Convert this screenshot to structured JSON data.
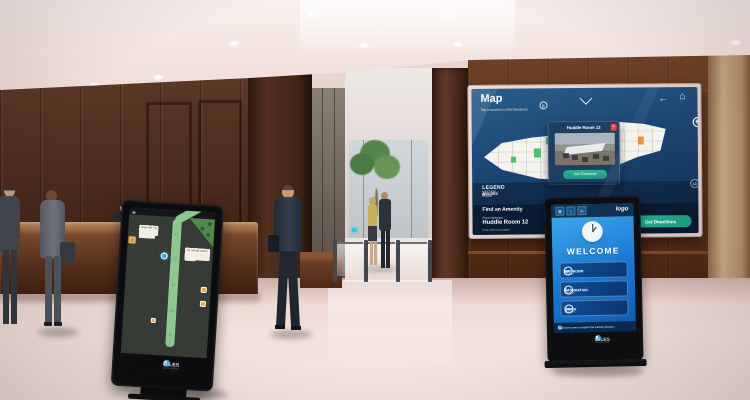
{
  "scene": {
    "description": "Corporate lobby with wall-mounted wayfinding display and two digital signage kiosks",
    "colors": {
      "wood": "#5a3a28",
      "floor": "#f2e0da",
      "screen_navy": "#1b4571",
      "kiosk_blue": "#1976d2",
      "accent_green": "#27b191",
      "brand_blue": "#35b1e8"
    }
  },
  "wall_display": {
    "title": "Map",
    "subtitle": "Tap a location to Get Directions",
    "nav": {
      "back_glyph": "←",
      "home_glyph": "⌂",
      "accessibility_glyph": "♿"
    },
    "side_controls": [
      {
        "name": "zoom-in",
        "glyph": "+"
      },
      {
        "name": "zoom-out",
        "glyph": "−"
      },
      {
        "name": "reset",
        "glyph": "↺"
      },
      {
        "name": "locate",
        "glyph": "◉"
      }
    ],
    "popup": {
      "title": "Huddle Room 12",
      "close_glyph": "×",
      "cta": "Get Directions"
    },
    "legend": {
      "label": "LEGEND",
      "items": [
        {
          "label": "AVAILABLE",
          "color": "#4cc06a"
        },
        {
          "label": "MEETING ROOM",
          "color": "#c05ce0"
        },
        {
          "label": "OCCUPIED",
          "color": "#e8c93c"
        }
      ]
    },
    "floors": {
      "campus": "CAMPUS",
      "levels": [
        "L1",
        "L2",
        "L3"
      ]
    },
    "amenity": {
      "header": "Find an Amenity",
      "selected_label": "Room Selected",
      "selected_room": "Huddle Room 12",
      "selected_sub": "from Current Location",
      "shortcuts": [
        {
          "glyph": "⇅",
          "label": "Elevator"
        },
        {
          "glyph": "↗",
          "label": "Exit"
        }
      ],
      "cta": "Get Directions",
      "cta_arrow": "→"
    }
  },
  "welcome_kiosk": {
    "logo": "logo",
    "topbar_tiles": [
      {
        "name": "directory-icon",
        "glyph": "▦"
      },
      {
        "name": "building-icon",
        "glyph": "⌂"
      },
      {
        "name": "map-icon",
        "glyph": "◎"
      }
    ],
    "welcome": "WELCOME",
    "rows": [
      {
        "icon_glyph": "WC",
        "label": "RESTROOM",
        "sub": "Tap for directions",
        "arrow": "→"
      },
      {
        "icon_glyph": "i",
        "label": "INFORMATION",
        "sub": "Tap for directions",
        "arrow": "↑"
      },
      {
        "icon_glyph": "Ψ",
        "label": "DINING",
        "sub": "Tap for directions",
        "arrow": "↓"
      }
    ],
    "ticker_info_glyph": "i",
    "ticker": "Touch the screen to explore the building directory",
    "brand": {
      "num": "22",
      "name": "MILES",
      "tagline": "DIGITAL SIGNAGE · WAYFINDING"
    }
  },
  "directory_kiosk": {
    "stores_left": [
      "Sole",
      "AT&T",
      "Sprint",
      "GameStop",
      "Bath & Body",
      "Candy B",
      "Nail Rite",
      "Flow"
    ],
    "stores_right": [
      "Lane Crawford",
      "Aveda",
      "Sun Diego",
      "Teaspoon Organics",
      "Harper Jewelers",
      "La Strada"
    ],
    "brand": {
      "num": "22",
      "name": "MILES",
      "tagline": "DIGITAL SIGNAGE · WAYFINDING"
    }
  }
}
